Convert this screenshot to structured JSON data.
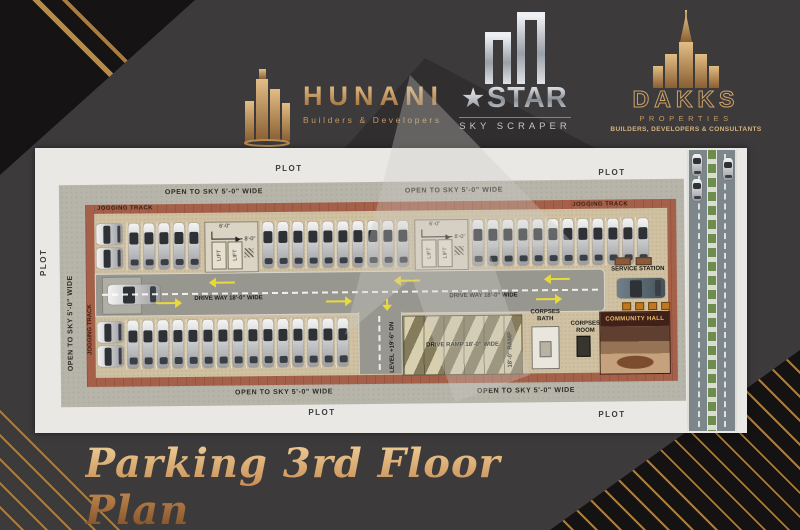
{
  "header": {
    "hunani": {
      "name": "HUNANI",
      "tagline": "Builders & Developers"
    },
    "star": {
      "name": "STAR",
      "tagline": "SKY SCRAPER"
    },
    "dakks": {
      "name": "DAKKS",
      "sub": "PROPERTIES",
      "tagline": "BUILDERS, DEVELOPERS & CONSULTANTS"
    }
  },
  "plan": {
    "plot_label": "PLOT",
    "open_to_sky": "OPEN TO SKY 5'-0\" WIDE",
    "jogging_track": "JOGGING TRACK",
    "drive_way": "DRIVE WAY 18'-0\" WIDE",
    "drive_ramp": "DRIVE RAMP 18'-0\" WIDE",
    "ramp_side": "18'-0\" RAMP",
    "ramp_level": "LEVEL +19'-6\" DN",
    "service_station": "SERVICE STATION",
    "corpses_bath": "CORPSES BATH",
    "corpses_room": "CORPSES ROOM",
    "community_hall": "COMMUNITY HALL",
    "lift_label": "LIFT",
    "dim_6": "6'-0\"",
    "dim_8": "8'-0\"",
    "parking": {
      "top_left_column": 2,
      "top_group_1": 5,
      "top_group_2": 10,
      "top_group_3": 12,
      "bottom_row": 15,
      "bottom_left_column": 2,
      "road_cars": 2
    }
  },
  "footer": {
    "title": "Parking 3rd Floor Plan"
  },
  "colors": {
    "gold": "#c49a62",
    "silver": "#c6cad1",
    "brick": "#a5604a",
    "floor_tan": "#cfc1a2",
    "asphalt": "#97978f",
    "arrow_yellow": "#ead93b",
    "bg_dark": "#3c3a3b"
  }
}
